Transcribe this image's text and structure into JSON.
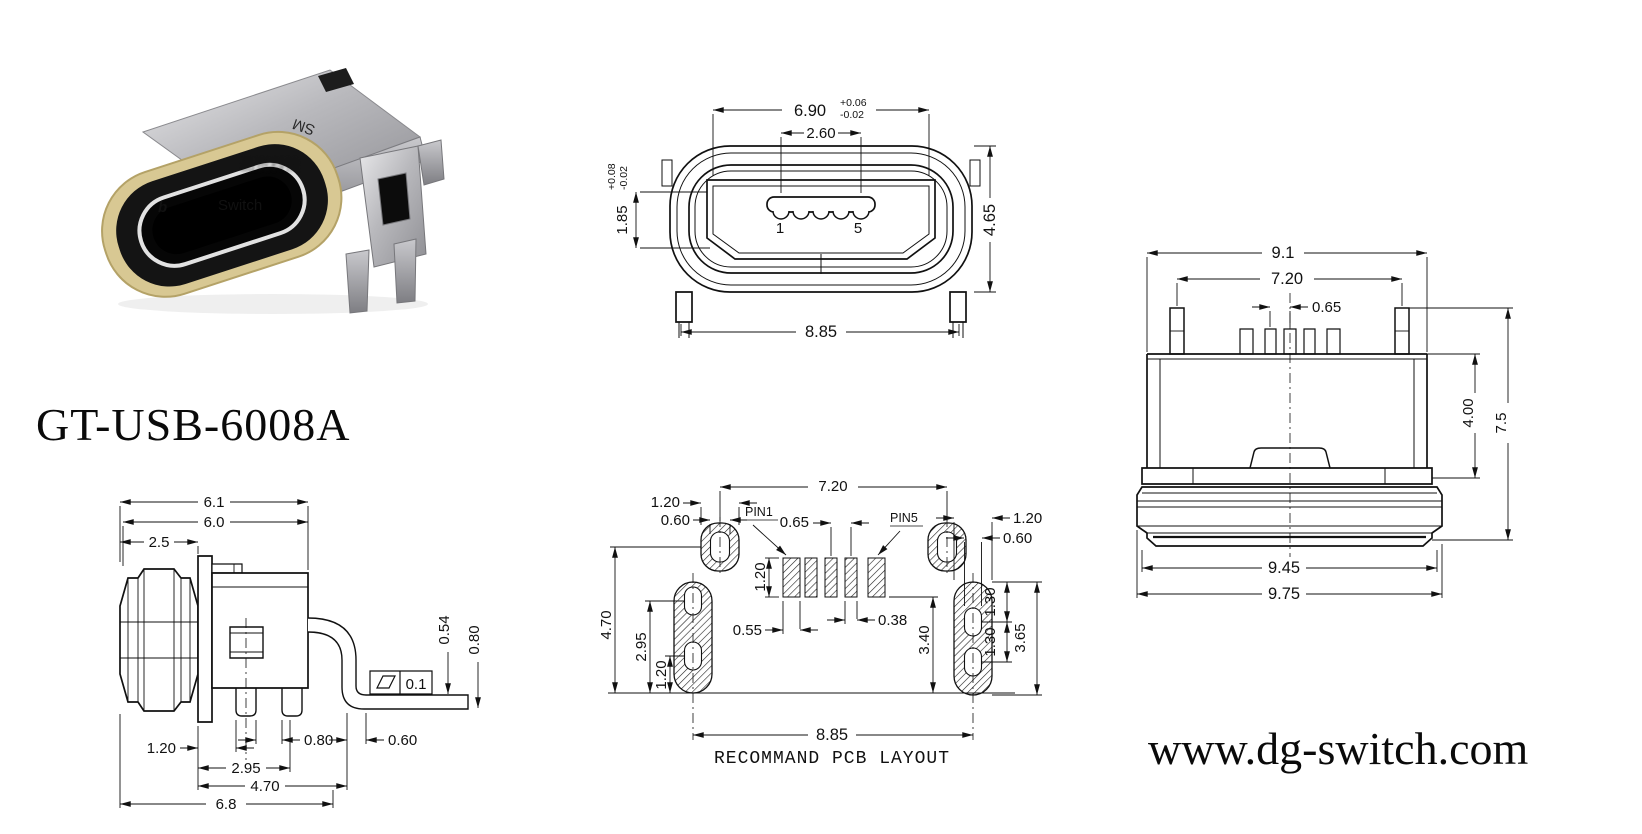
{
  "part_number": "GT-USB-6008A",
  "website": "www.dg-switch.com",
  "photo": {
    "shell_marking": "SM",
    "watermark_b": "b",
    "watermark_switch": "Switch",
    "watermark_cn": "品赞科技"
  },
  "front_view": {
    "dim_width": "6.90",
    "dim_width_tol_up": "+0.06",
    "dim_width_tol_dn": "-0.02",
    "dim_tongue": "2.60",
    "dim_opening": "1.85",
    "dim_opening_tol_up": "+0.08",
    "dim_opening_tol_dn": "-0.02",
    "dim_height": "4.65",
    "dim_leg_span": "8.85",
    "pin_first": "1",
    "pin_last": "5"
  },
  "side_view": {
    "dim_total_w": "6.1",
    "dim_body_w": "6.0",
    "dim_gasket_w": "2.5",
    "dim_leg_offset": "1.20",
    "dim_leg_gap": "0.80",
    "dim_leg2_pos": "2.95",
    "dim_lead_pos": "4.70",
    "dim_overall": "6.8",
    "dim_foot_len": "0.60",
    "dim_foot_h1": "0.54",
    "dim_foot_h2": "0.80",
    "flatness_tol": "0.1"
  },
  "pcb_view": {
    "caption": "RECOMMAND PCB LAYOUT",
    "pin1_label": "PIN1",
    "pin5_label": "PIN5",
    "dim_ring_span": "7.20",
    "dim_ring_outer": "1.20",
    "dim_ring_inner": "0.60",
    "dim_pitch": "0.65",
    "dim_pad_h": "1.20",
    "dim_pad_w1": "0.55",
    "dim_pad_w2": "0.38",
    "dim_pad_to_base": "3.40",
    "dim_ring_to_base": "4.70",
    "dim_hole1_to_base": "2.95",
    "dim_hole2_to_base": "1.20",
    "dim_slot_outer": "1.20",
    "dim_slot_inner": "0.60",
    "dim_slot_seg1": "1.30",
    "dim_slot_seg2": "1.30",
    "dim_slot_len": "3.65",
    "dim_slot_span": "8.85"
  },
  "top_view": {
    "dim_overall_w": "9.1",
    "dim_post_span": "7.20",
    "dim_pitch": "0.65",
    "dim_body_depth": "4.00",
    "dim_total_depth": "7.5",
    "dim_gasket_inner": "9.45",
    "dim_gasket_outer": "9.75"
  }
}
